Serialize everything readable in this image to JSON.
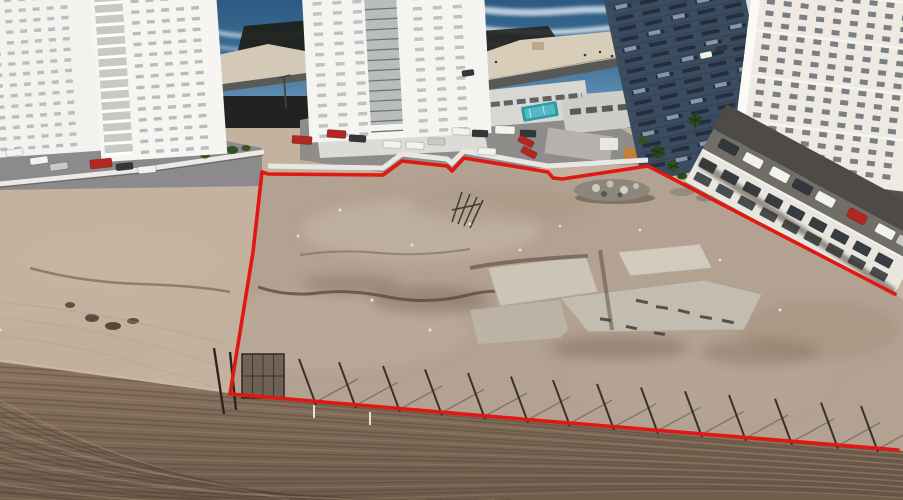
{
  "meta": {
    "description": "Aerial drone photograph of a coastal vacant sandy lot outlined with a red boundary line, surrounded by white high-rise towers, beachfront road, ocean surf, parking lots with cars, a leaning fence line along the lower boundary and tire-tracked dirt in the foreground"
  },
  "scene": {
    "width": 903,
    "height": 500,
    "colors": {
      "outline_red": "#e01812",
      "ocean_deep": "#2c5a82",
      "ocean_light": "#4d82aa",
      "foam": "#e9f2f6",
      "beach_sand": "#d8cdb9",
      "road": "#5a5a56",
      "pool_teal": "#2f9aa6",
      "palm_green": "#2e4a22",
      "sand_outside": "#c4b19f",
      "sand_lot": "#b3a191",
      "concrete_pad": "#ccc4b7",
      "dirt_foreground": "#8b7462",
      "dirt_dark": "#6f5c4b",
      "track_dark": "#54453a",
      "track_light": "#a68f77",
      "fence_post": "#38302a",
      "fence_shadow": "rgba(52,42,32,0.4)",
      "white_post": "#e8e2d8",
      "car_white": "#f2f2ef",
      "car_silver": "#c9c9c6",
      "car_dark": "#33373b",
      "car_red": "#b42620",
      "wall_white": "#e9e6e0",
      "deck_gray": "#716e68",
      "window_dark": "#363c40"
    },
    "red_outline": {
      "stroke_width": 3.6,
      "upper_path": [
        [
          262,
          172
        ],
        [
          268,
          174
        ],
        [
          383,
          175
        ],
        [
          402,
          161
        ],
        [
          447,
          166
        ],
        [
          452,
          171
        ],
        [
          464,
          158
        ],
        [
          530,
          169
        ],
        [
          548,
          172
        ],
        [
          553,
          178
        ],
        [
          562,
          179
        ],
        [
          648,
          166
        ],
        [
          895,
          294
        ]
      ],
      "left_bottom_path": [
        [
          262,
          172
        ],
        [
          253,
          252
        ],
        [
          230,
          394
        ],
        [
          545,
          421
        ],
        [
          898,
          450
        ]
      ]
    },
    "towers": [
      {
        "name": "left-tower-a",
        "x": -14,
        "y": -16,
        "w": 114,
        "h": 170,
        "rot": -4,
        "cx": 50,
        "cy": 85,
        "fill": "#f3f2ee",
        "rows": 15,
        "cols": 6,
        "px": 10,
        "py": 12,
        "gw": 14,
        "gh": 10.6,
        "ww": 7,
        "wh": 3.4,
        "wc": "#a8acae",
        "wop": 0.75
      },
      {
        "name": "left-tower-b",
        "x": 96,
        "y": -14,
        "w": 126,
        "h": 172,
        "rot": -4,
        "cx": 160,
        "cy": 80,
        "fill": "#f6f5f2",
        "rows": 15,
        "cols": 5,
        "px": 40,
        "py": 12,
        "gw": 15,
        "gh": 10.8,
        "ww": 8,
        "wh": 3.4,
        "wc": "#9fa4a6",
        "wop": 0.7,
        "balcony": {
          "bx": 4,
          "bw": 28,
          "back": "#c9c9c4",
          "bar": "#ffffff"
        }
      },
      {
        "name": "center-tower",
        "x": 306,
        "y": -12,
        "w": 182,
        "h": 150,
        "rot": -3,
        "cx": 395,
        "cy": 70,
        "fill": "#f5f4f0",
        "rows": 14,
        "cols": 8,
        "px": 10,
        "py": 10,
        "gw": 20,
        "gh": 10.2,
        "ww": 9,
        "wh": 3.4,
        "wc": "#9aa0a2",
        "wop": 0.6,
        "column": {
          "bx": 62,
          "bw": 32,
          "back": "#babdbe",
          "lines": "#6f7577"
        }
      },
      {
        "name": "glass-tower",
        "x": 618,
        "y": -16,
        "w": 146,
        "h": 186,
        "rot": -12,
        "cx": 690,
        "cy": 60,
        "fill": "#3c4c60",
        "rows": 16,
        "cols": 5,
        "px": 8,
        "py": 8,
        "gw": 27,
        "gh": 10.8,
        "ww": 18,
        "wh": 4,
        "wc": "#1e2a38",
        "wop": 0.85,
        "specks": "#9db1c4",
        "floorline": "#2a3747",
        "edgeRight": {
          "w": 7,
          "color": "#dfe2e4"
        }
      },
      {
        "name": "right-tower",
        "x": 744,
        "y": -18,
        "w": 175,
        "h": 196,
        "rot": 7,
        "cx": 800,
        "cy": 60,
        "fill": "#eeeae1",
        "rows": 16,
        "cols": 9,
        "px": 16,
        "py": 10,
        "gw": 17,
        "gh": 11.4,
        "ww": 8,
        "wh": 5,
        "wc": "#5b646b",
        "wop": 0.8,
        "bands": "#f7f5ef",
        "edgeLeft": {
          "w": 9,
          "color": "#fbfaf6"
        }
      }
    ],
    "roof_structure": {
      "x": 702,
      "y": 150,
      "angle": 28.3,
      "length": 238,
      "wall_h": 36,
      "deck_h": 24,
      "deck_cars": [
        {
          "lx": 12,
          "c": "car_dark"
        },
        {
          "lx": 40,
          "c": "car_white"
        },
        {
          "lx": 70,
          "c": "car_white"
        },
        {
          "lx": 96,
          "c": "car_dark"
        },
        {
          "lx": 122,
          "c": "car_white"
        },
        {
          "lx": 158,
          "c": "car_red"
        },
        {
          "lx": 190,
          "c": "car_white"
        },
        {
          "lx": 214,
          "c": "car_silver"
        }
      ]
    },
    "cars": {
      "ground": [
        {
          "x": 6,
          "y": 149,
          "w": 17,
          "h": 7,
          "a": -8,
          "c": "car_white"
        },
        {
          "x": 30,
          "y": 157,
          "w": 18,
          "h": 7,
          "a": -8,
          "c": "car_white"
        },
        {
          "x": 50,
          "y": 163,
          "w": 18,
          "h": 7,
          "a": -8,
          "c": "car_silver"
        },
        {
          "x": 90,
          "y": 159,
          "w": 22,
          "h": 9,
          "a": -6,
          "c": "car_red"
        },
        {
          "x": 116,
          "y": 163,
          "w": 17,
          "h": 7,
          "a": -6,
          "c": "car_dark"
        },
        {
          "x": 138,
          "y": 166,
          "w": 18,
          "h": 7,
          "a": -6,
          "c": "car_white"
        },
        {
          "x": 292,
          "y": 136,
          "w": 20,
          "h": 8,
          "a": 4,
          "c": "car_red"
        },
        {
          "x": 327,
          "y": 130,
          "w": 19,
          "h": 8,
          "a": 4,
          "c": "car_red"
        },
        {
          "x": 349,
          "y": 135,
          "w": 17,
          "h": 7,
          "a": 4,
          "c": "car_dark"
        },
        {
          "x": 383,
          "y": 141,
          "w": 18,
          "h": 7,
          "a": 2,
          "c": "car_white"
        },
        {
          "x": 406,
          "y": 142,
          "w": 18,
          "h": 7,
          "a": 2,
          "c": "car_white"
        },
        {
          "x": 428,
          "y": 138,
          "w": 17,
          "h": 7,
          "a": 2,
          "c": "car_silver"
        },
        {
          "x": 452,
          "y": 128,
          "w": 18,
          "h": 7,
          "a": 2,
          "c": "car_white"
        },
        {
          "x": 472,
          "y": 130,
          "w": 16,
          "h": 7,
          "a": 2,
          "c": "car_dark"
        },
        {
          "x": 495,
          "y": 126,
          "w": 20,
          "h": 8,
          "a": 2,
          "c": "car_white"
        },
        {
          "x": 520,
          "y": 130,
          "w": 16,
          "h": 7,
          "a": 2,
          "c": "car_dark"
        },
        {
          "x": 478,
          "y": 148,
          "w": 18,
          "h": 7,
          "a": 2,
          "c": "car_white"
        },
        {
          "x": 518,
          "y": 138,
          "w": 16,
          "h": 7,
          "a": 28,
          "c": "car_red"
        },
        {
          "x": 521,
          "y": 149,
          "w": 16,
          "h": 7,
          "a": 28,
          "c": "car_red"
        },
        {
          "x": 462,
          "y": 70,
          "w": 12,
          "h": 6,
          "a": -8,
          "c": "car_dark"
        },
        {
          "x": 700,
          "y": 52,
          "w": 12,
          "h": 6,
          "a": -12,
          "c": "car_white"
        },
        {
          "x": 716,
          "y": 46,
          "w": 11,
          "h": 5,
          "a": -12,
          "c": "car_dark"
        }
      ]
    },
    "fence": {
      "bottom_line": {
        "x1": 230,
        "y1": 394,
        "x2": 898,
        "y2": 450
      },
      "posts_x": [
        312,
        352,
        396,
        438,
        481,
        524,
        566,
        610,
        654,
        698,
        742,
        788,
        834,
        874
      ],
      "white_posts": [
        {
          "x": 314,
          "y": 405
        },
        {
          "x": 370,
          "y": 412
        }
      ],
      "mesh_panel": {
        "x": 242,
        "y": 354,
        "w": 42,
        "h": 44
      },
      "corner_poles": [
        [
          214,
          348,
          224,
          414
        ],
        [
          230,
          352,
          236,
          410
        ]
      ]
    },
    "tracks": {
      "long_count": 28,
      "fan_count": 14
    }
  }
}
